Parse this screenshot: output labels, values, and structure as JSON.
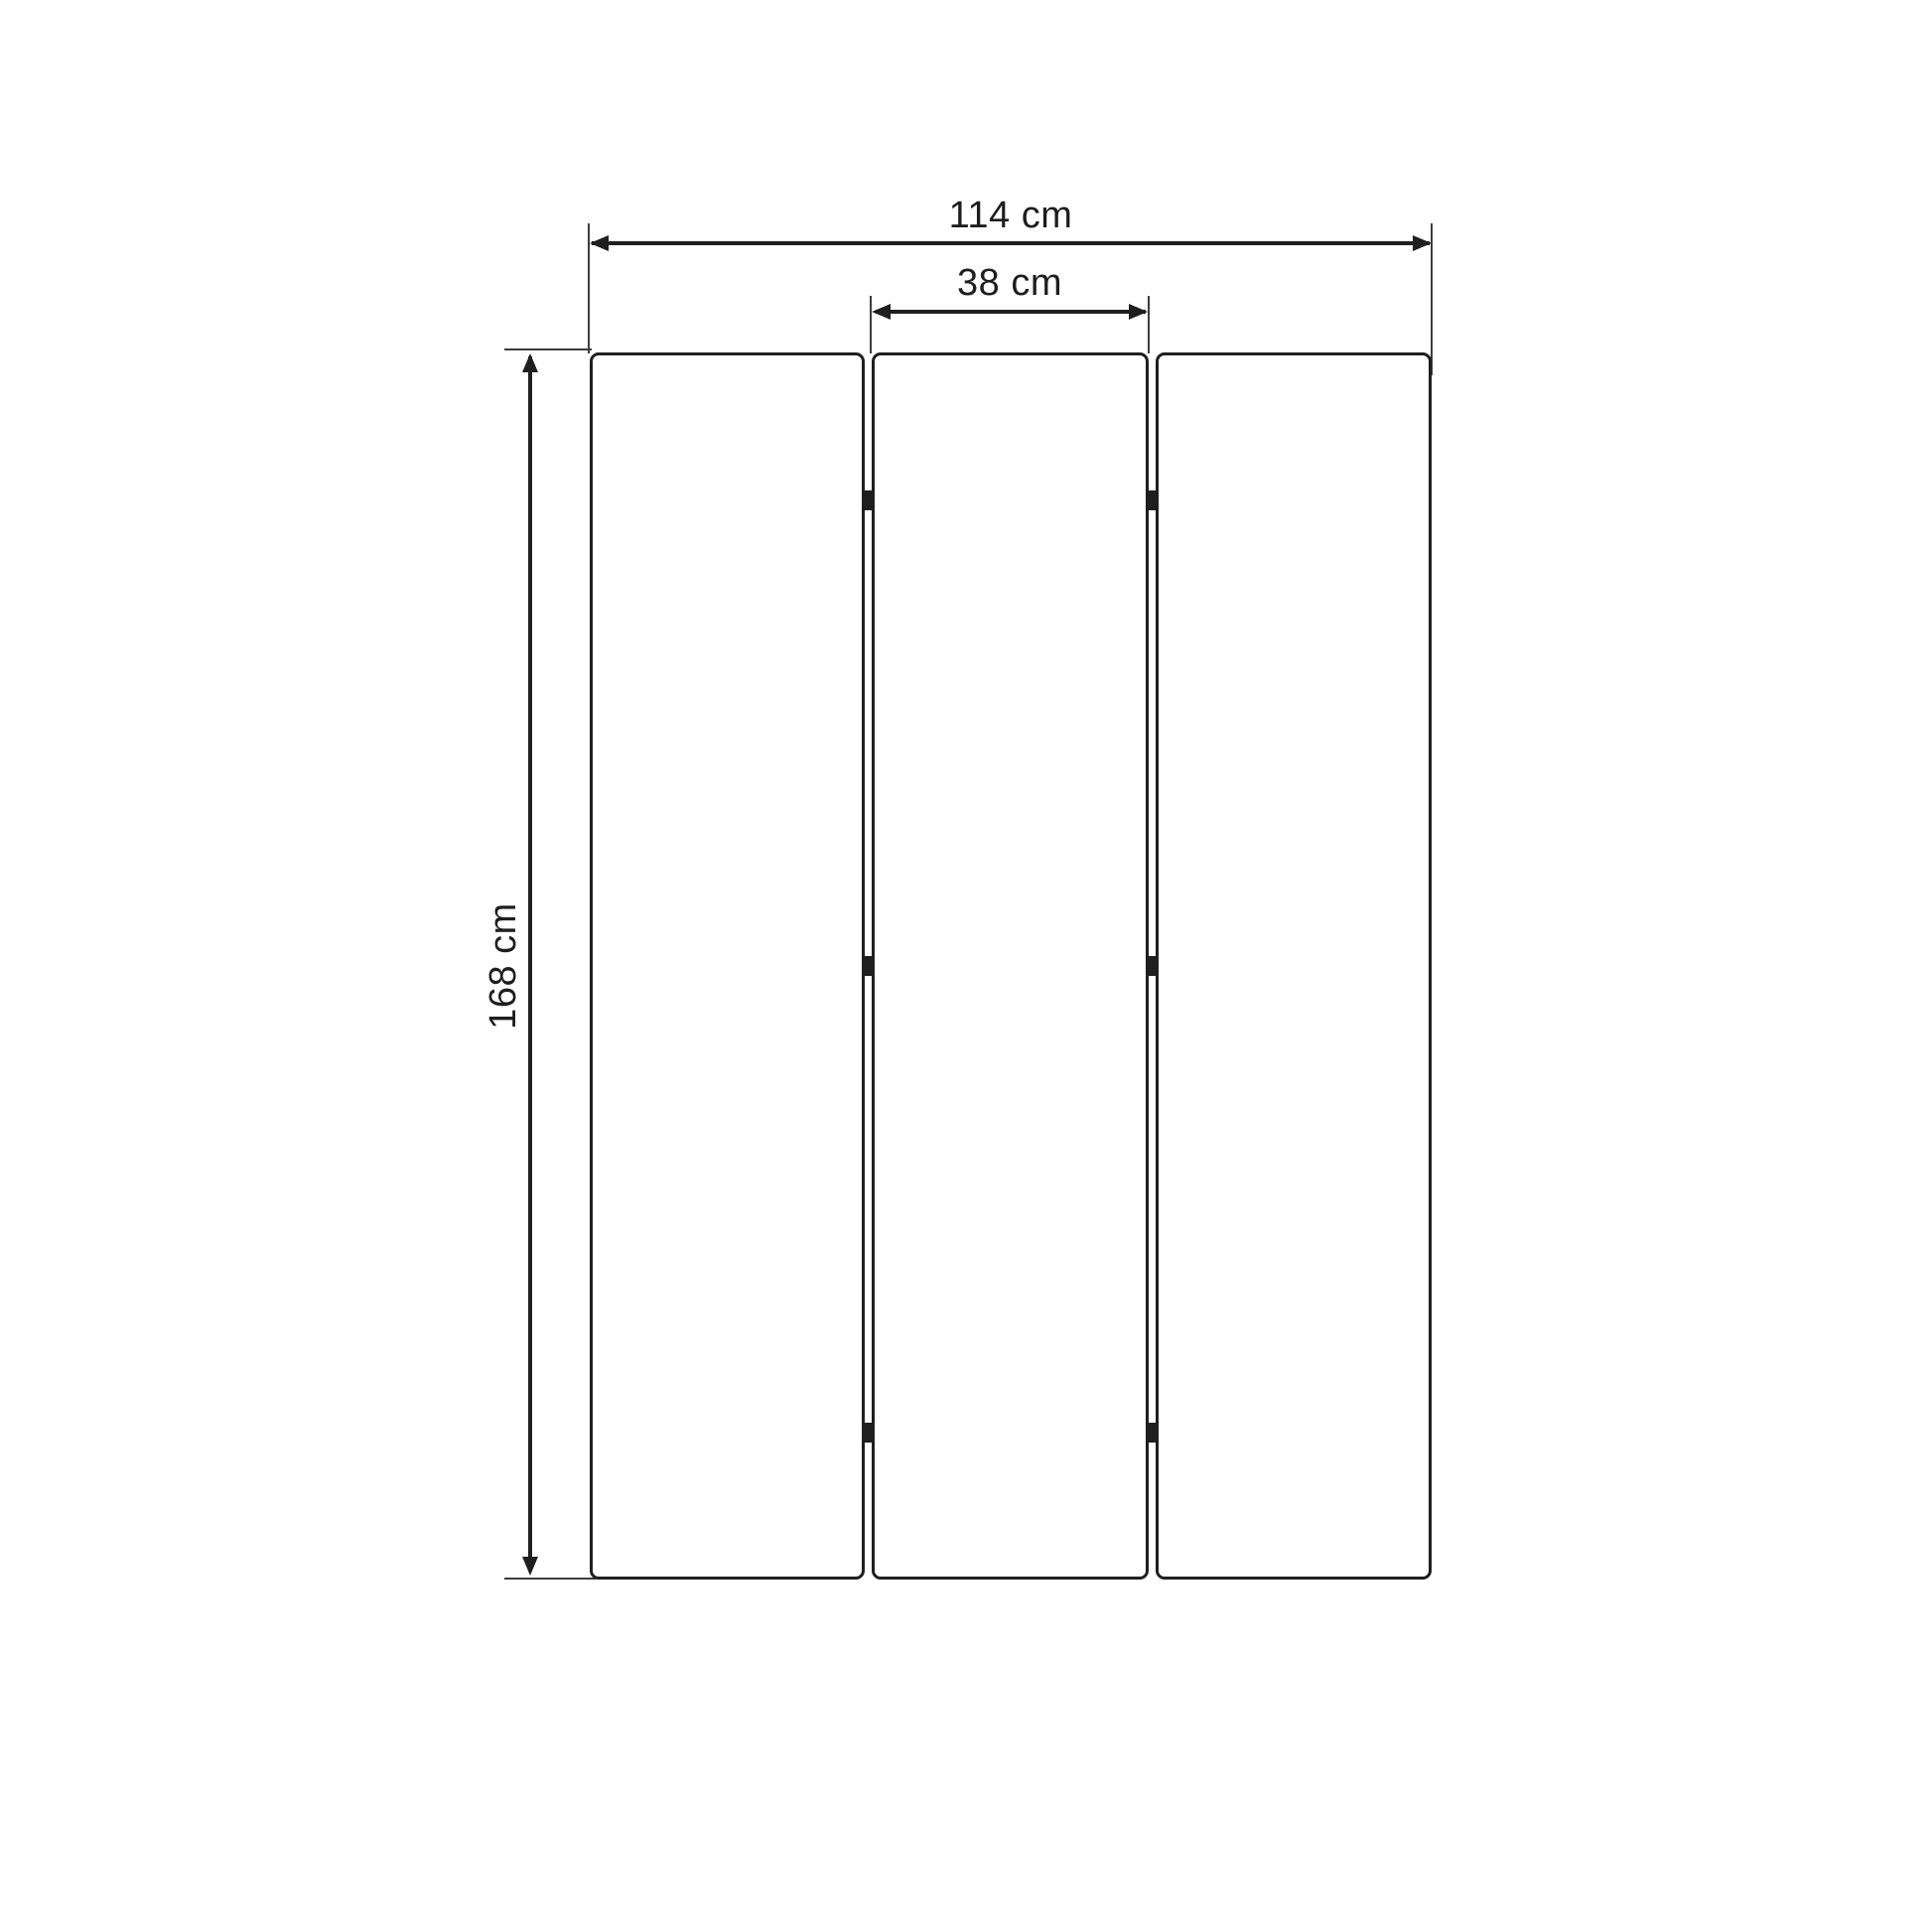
{
  "diagram": {
    "type": "dimension-drawing",
    "subject": "three-panel folding screen (room divider), front view",
    "panel_count": 3,
    "hinges_per_gap": 3,
    "dimensions": {
      "total_width": {
        "label": "114 cm",
        "value": 114,
        "unit": "cm"
      },
      "panel_width": {
        "label": "38 cm",
        "value": 38,
        "unit": "cm"
      },
      "height": {
        "label": "168 cm",
        "value": 168,
        "unit": "cm"
      }
    },
    "colors": {
      "background": "#ffffff",
      "panel_fill": "#ffffff",
      "outline": "#1f1f1f",
      "extension_line": "#3d3d3d",
      "text": "#1e1e1e"
    }
  }
}
